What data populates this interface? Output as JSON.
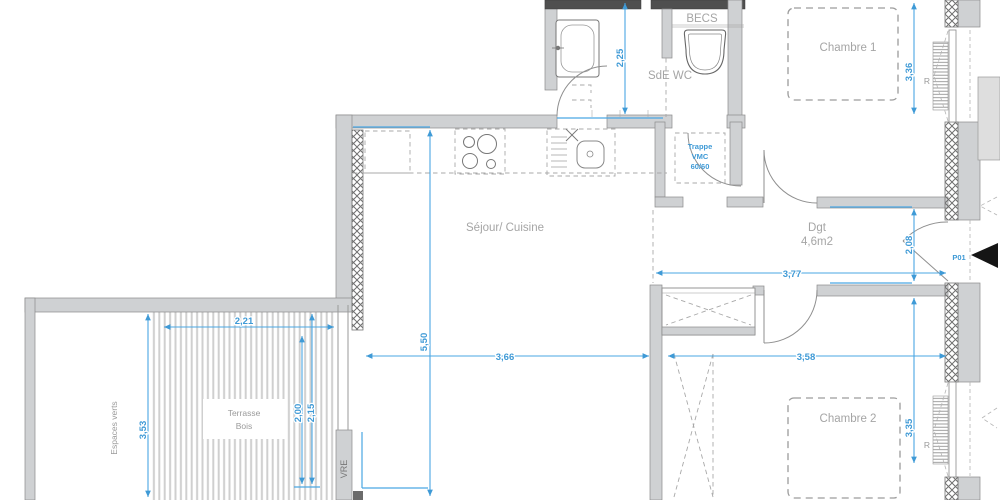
{
  "rooms": {
    "bathroom": "SdE WC",
    "water_heater": "BECS",
    "bedroom1": "Chambre 1",
    "bedroom2": "Chambre 2",
    "living": "Séjour/ Cuisine",
    "hallway": "Dgt",
    "hallway_area": "4,6m2",
    "terrace_line1": "Terrasse",
    "terrace_line2": "Bois",
    "green_space": "Espaces verts",
    "window_label": "VRE"
  },
  "annotations": {
    "vmc_line1": "Trappe",
    "vmc_line2": "VMC",
    "vmc_line3": "60/60",
    "entrance_door": "P01",
    "radiator": "R"
  },
  "dimensions": {
    "bath_height": "2,25",
    "bedroom1_width": "3,36",
    "terrace_deck_width": "2,21",
    "terrace_height": "3,53",
    "deck_depth_a": "2,00",
    "deck_depth_b": "2,15",
    "living_height": "5,50",
    "living_width": "3,66",
    "hallway_width": "3,77",
    "hallway_height": "2,08",
    "bedroom2_width": "3,58",
    "bedroom2_height": "3,35"
  },
  "colors": {
    "dimension_blue": "#3f9ad6",
    "room_label_gray": "#a5a5a5",
    "wall_fill": "#cfd1d3",
    "wall_dark": "#4f4f4f",
    "entrance_marker": "#151515"
  }
}
